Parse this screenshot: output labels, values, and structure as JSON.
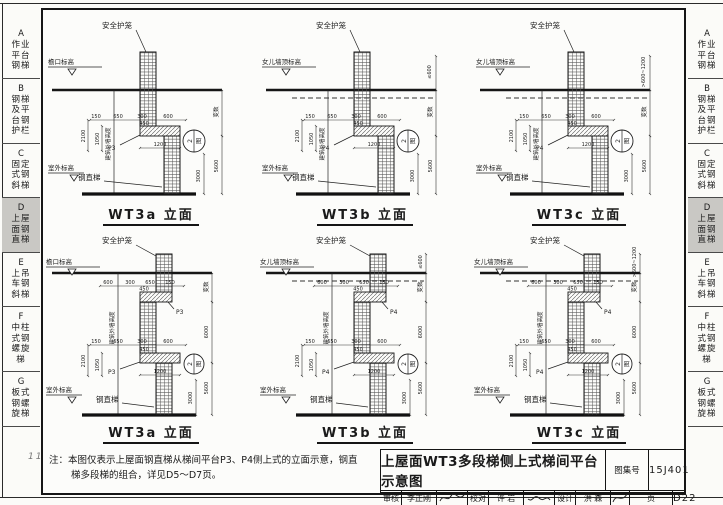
{
  "page": {
    "corner_mark": "111"
  },
  "sidebar": {
    "items": [
      {
        "letter": "A",
        "label": "作业平台钢梯",
        "selected": false
      },
      {
        "letter": "B",
        "label": "钢梯及平台钢护栏",
        "selected": false
      },
      {
        "letter": "C",
        "label": "固定式钢斜梯",
        "selected": false
      },
      {
        "letter": "D",
        "label": "上屋面钢直梯",
        "selected": true
      },
      {
        "letter": "E",
        "label": "上吊车钢斜梯",
        "selected": false
      },
      {
        "letter": "F",
        "label": "中柱式钢螺旋梯",
        "selected": false
      },
      {
        "letter": "G",
        "label": "板式钢螺旋梯",
        "selected": false
      }
    ]
  },
  "diagrams": [
    {
      "title": "WT3a 立面",
      "top_level": "檐口标高",
      "parapet_dim": "",
      "platform": "P3",
      "safety_cage": "安全护笼",
      "steel_ladder": "钢直梯",
      "outdoor_level": "室外标高",
      "wall_height": "建筑外墙高度",
      "dims_top": [
        "150",
        "650",
        "300",
        "600"
      ],
      "dim_450": "450",
      "dim_2100": "2100",
      "dim_1050": "1050",
      "dim_1200": "1200",
      "dim_var": "变数",
      "dim_5600": "5600",
      "dim_3000": "3000",
      "balloon_top": "2",
      "balloon_bottom": "图"
    },
    {
      "title": "WT3b 立面",
      "top_level": "女儿墙顶标高",
      "parapet_dim": "≤600",
      "platform": "P4",
      "safety_cage": "安全护笼",
      "steel_ladder": "钢直梯",
      "outdoor_level": "室外标高",
      "wall_height": "建筑外墙高度",
      "dims_top": [
        "150",
        "650",
        "300",
        "600"
      ],
      "dim_450": "450",
      "dim_2100": "2100",
      "dim_1050": "1050",
      "dim_1200": "1200",
      "dim_var": "变数",
      "dim_5600": "5600",
      "dim_3000": "3000",
      "balloon_top": "2",
      "balloon_bottom": "图"
    },
    {
      "title": "WT3c 立面",
      "top_level": "女儿墙顶标高",
      "parapet_dim": ">600~1200",
      "platform": "P4",
      "safety_cage": "安全护笼",
      "steel_ladder": "钢直梯",
      "outdoor_level": "室外标高",
      "wall_height": "建筑外墙高度",
      "dims_top": [
        "150",
        "650",
        "300",
        "600"
      ],
      "dim_450": "450",
      "dim_2100": "2100",
      "dim_1050": "1050",
      "dim_1200": "1200",
      "dim_var": "变数",
      "dim_5600": "5600",
      "dim_3000": "3000",
      "balloon_top": "2",
      "balloon_bottom": "图"
    },
    {
      "title": "WT3a 立面",
      "top_level": "檐口标高",
      "parapet_dim": "",
      "platform": "P3",
      "safety_cage": "安全护笼",
      "steel_ladder": "钢直梯",
      "outdoor_level": "室外标高",
      "wall_height": "建筑外墙高度",
      "dims_upper": [
        "600",
        "300",
        "650",
        "150"
      ],
      "dim_450u": "450",
      "dims_top": [
        "150",
        "650",
        "300",
        "600"
      ],
      "dim_450": "450",
      "dim_2100": "2100",
      "dim_1050": "1050",
      "dim_1200": "1200",
      "dim_var": "变数",
      "dim_6000": "6000",
      "dim_5600": "5600",
      "dim_3000": "3000",
      "balloon_top": "2",
      "balloon_bottom": "图"
    },
    {
      "title": "WT3b 立面",
      "top_level": "女儿墙顶标高",
      "parapet_dim": "≤600",
      "platform": "P4",
      "safety_cage": "安全护笼",
      "steel_ladder": "钢直梯",
      "outdoor_level": "室外标高",
      "wall_height": "建筑外墙高度",
      "dims_upper": [
        "600",
        "300",
        "650",
        "150"
      ],
      "dim_450u": "450",
      "dims_top": [
        "150",
        "650",
        "300",
        "600"
      ],
      "dim_450": "450",
      "dim_2100": "2100",
      "dim_1050": "1050",
      "dim_1200": "1200",
      "dim_var": "变数",
      "dim_6000": "6000",
      "dim_5600": "5600",
      "dim_3000": "3000",
      "balloon_top": "2",
      "balloon_bottom": "图"
    },
    {
      "title": "WT3c 立面",
      "top_level": "女儿墙顶标高",
      "parapet_dim": ">600~1200",
      "platform": "P4",
      "safety_cage": "安全护笼",
      "steel_ladder": "钢直梯",
      "outdoor_level": "室外标高",
      "wall_height": "建筑外墙高度",
      "dims_upper": [
        "600",
        "300",
        "650",
        "150"
      ],
      "dim_450u": "450",
      "dims_top": [
        "150",
        "650",
        "300",
        "600"
      ],
      "dim_450": "450",
      "dim_2100": "2100",
      "dim_1050": "1050",
      "dim_1200": "1200",
      "dim_var": "变数",
      "dim_6000": "6000",
      "dim_5600": "5600",
      "dim_3000": "3000",
      "balloon_top": "2",
      "balloon_bottom": "图"
    }
  ],
  "note": {
    "label": "注：",
    "line1": "本图仅表示上屋面钢直梯从梯间平台P3、P4侧上式的立面示意，钢直",
    "line2": "梯多段梯的组合，详见D5～D7页。"
  },
  "titleblock": {
    "title": "上屋面WT3多段梯侧上式梯间平台示意图",
    "atlas_label": "图集号",
    "atlas_no": "15J401",
    "page_label": "页",
    "page_no": "D22",
    "review_label": "审核",
    "review_name": "李正刚",
    "check_label": "校对",
    "check_name": "许 岩",
    "design_label": "设计",
    "design_name": "洪 森"
  }
}
